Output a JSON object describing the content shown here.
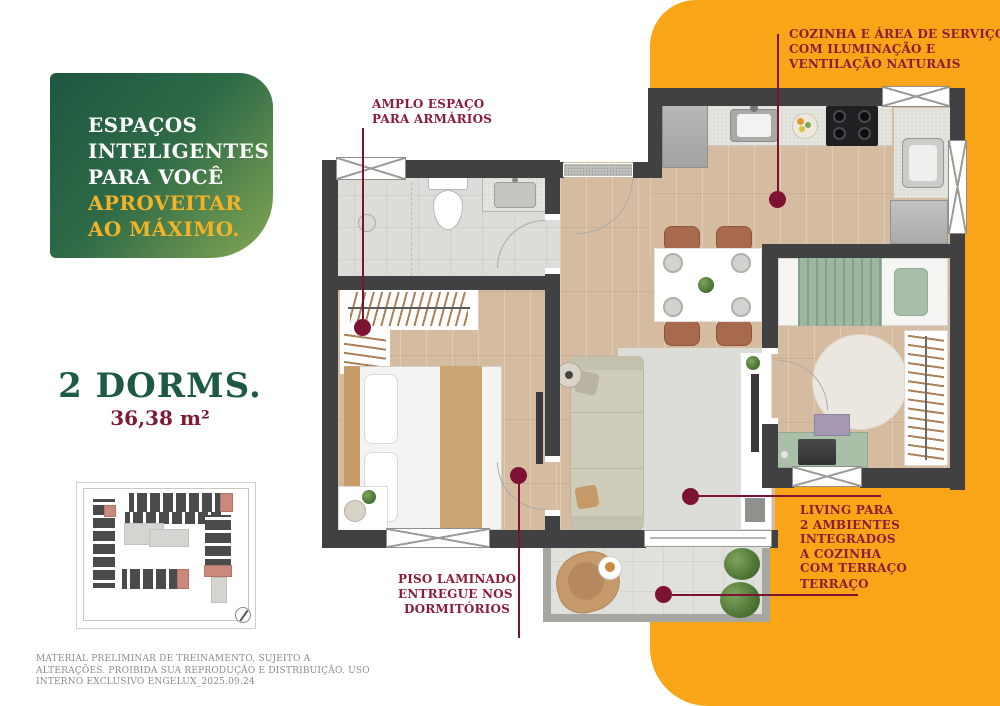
{
  "palette": {
    "orange": "#F8A617",
    "green_dark": "#1E5640",
    "green_light": "#84A854",
    "headline_yellow": "#F2B32A",
    "title_green": "#1D5943",
    "area_maroon": "#7E1B33",
    "callout_maroon": "#8E1C38",
    "callout_line": "#7D1232",
    "wall_charcoal": "#414144"
  },
  "headline": {
    "line1": "ESPAÇOS",
    "line2": "INTELIGENTES",
    "line3": "PARA VOCÊ",
    "line4": "APROVEITAR",
    "line5": "AO MÁXIMO."
  },
  "unit": {
    "rooms": "2 DORMS.",
    "area": "36,38 m²"
  },
  "callouts": {
    "closet": {
      "line1": "AMPLO ESPAÇO",
      "line2": "PARA ARMÁRIOS"
    },
    "kitchen": {
      "line1": "COZINHA E ÁREA DE SERVIÇO",
      "line2": "COM ILUMINAÇÃO E",
      "line3": "VENTILAÇÃO NATURAIS"
    },
    "living": {
      "line1": "LIVING PARA",
      "line2": "2 AMBIENTES",
      "line3": "INTEGRADOS",
      "line4": "A COZINHA",
      "line5": "COM TERRAÇO"
    },
    "terrace": {
      "line1": "TERRAÇO"
    },
    "flooring": {
      "line1": "PISO LAMINADO",
      "line2": "ENTREGUE NOS",
      "line3": "DORMITÓRIOS"
    }
  },
  "disclaimer": {
    "text": "MATERIAL PRELIMINAR DE TREINAMENTO, SUJEITO A ALTERAÇÕES. PROIBIDA SUA REPRODUÇÃO E DISTRIBUIÇÃO. USO INTERNO EXCLUSIVO ENGELUX_2025.09.24"
  }
}
